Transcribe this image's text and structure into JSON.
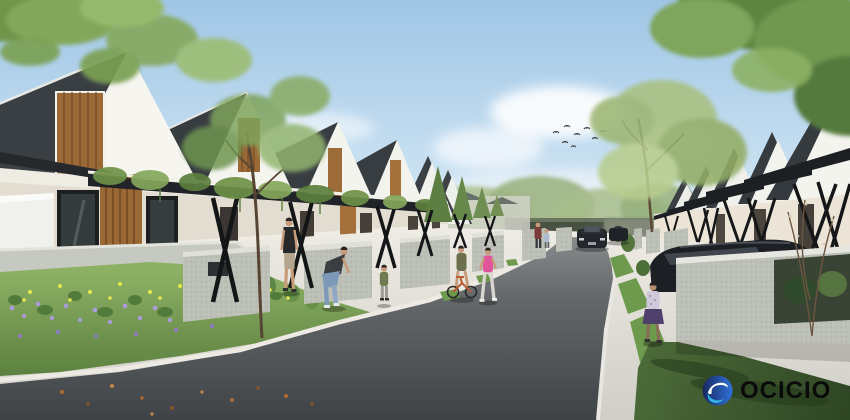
{
  "watermark": {
    "brand_text": "OCICIO",
    "logo_icon": "ocicio-circle-swoosh-icon"
  },
  "scene": {
    "description": "Daytime architectural rendering of a modern residential housing cluster: rows of white gable-roof houses with wooden accents and black X-brace carport pergolas lining a straight asphalt street that curves past a flower bed in the left foreground.",
    "left_house_count": 6,
    "right_house_count": 5,
    "people": [
      "man in black t-shirt walking",
      "woman bending forward",
      "toddler walking",
      "child on small bicycle",
      "girl in pink running",
      "girl in purple skirt on right sidewalk",
      "adult with child in the distance"
    ],
    "vehicles": [
      "dark sedan driving up street",
      "second dark sedan behind it",
      "dark sedan parked under right carport"
    ],
    "birds_count": 8
  },
  "colors": {
    "sky_top": "#9fc6e6",
    "sky_horizon": "#e9f1f7",
    "roof_dark": "#3a3f44",
    "wall_white": "#f4f3ee",
    "wall_cream": "#ece5d7",
    "wood_accent": "#9a6936",
    "frame_black": "#17181a",
    "asphalt_near": "#3f4347",
    "asphalt_far": "#8b8e8f",
    "sidewalk": "#d9d8d2",
    "curb_white": "#eceae2",
    "grass_sun": "#7ba455",
    "lawn_shadow": "#3c5a31",
    "flower_purple": "#a99bd6",
    "flower_yellow": "#e4e74f",
    "concrete_fence": "#bcc0b7",
    "car_dark": "#23262b",
    "logo_blue_dark": "#19275f",
    "logo_blue": "#2f72d9",
    "logo_cyan": "#30b4e6",
    "logo_text": "#0a0a0a"
  }
}
